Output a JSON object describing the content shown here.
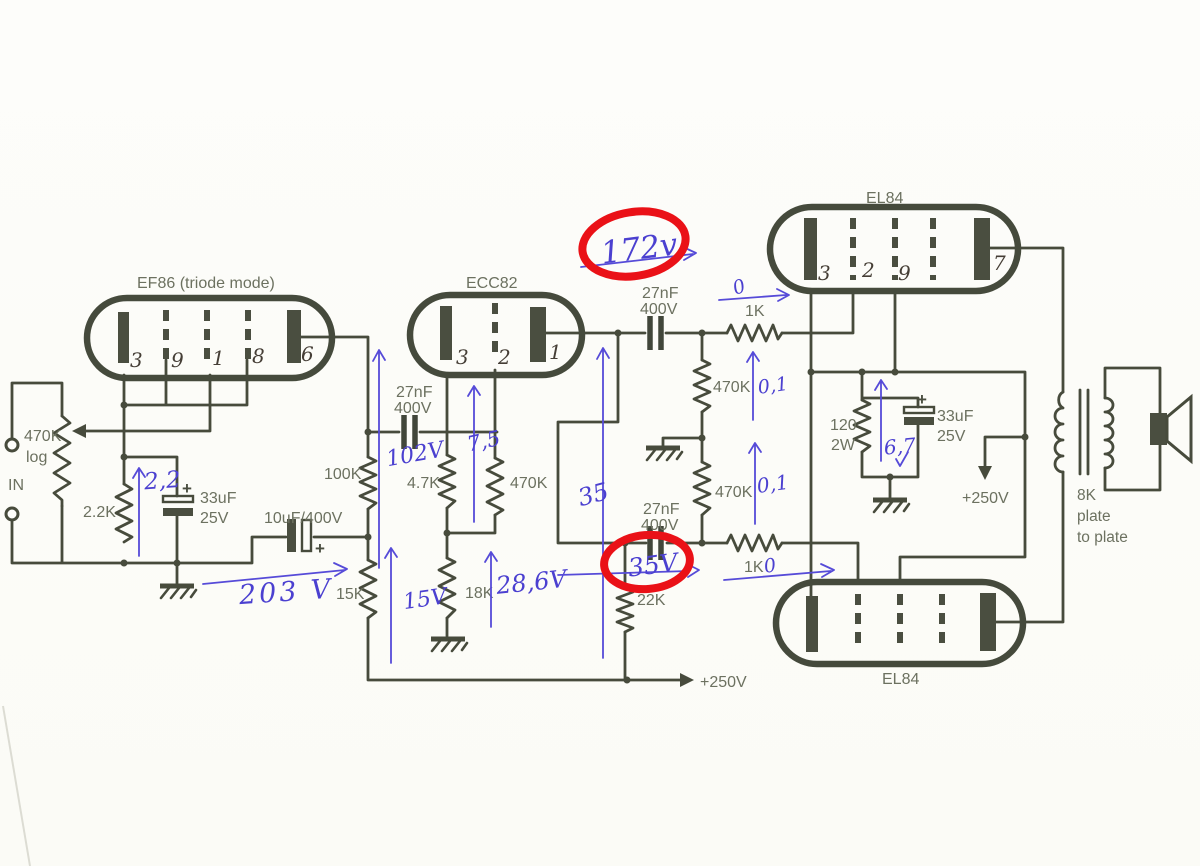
{
  "colors": {
    "ink": "#474b3c",
    "printed_text": "#6c7160",
    "handwriting_blue": "#4b40d0",
    "highlight_red": "#ea1117",
    "paper": "#fbfbf7"
  },
  "tubes": {
    "ef86": {
      "label": "EF86 (triode mode)",
      "pins": [
        "3",
        "9",
        "1",
        "8",
        "6"
      ]
    },
    "ecc82": {
      "label": "ECC82",
      "pins": [
        "3",
        "2",
        "1"
      ]
    },
    "el84_top": {
      "label": "EL84",
      "pins": [
        "3",
        "2",
        "9",
        "7"
      ]
    },
    "el84_bottom": {
      "label": "EL84"
    }
  },
  "labels": {
    "input": "IN",
    "pot_value": "470K",
    "pot_taper": "log",
    "r_2k2": "2.2K",
    "c33u_left_value": "33uF",
    "c33u_left_voltage": "25V",
    "c10u": "10uF/400V",
    "r_100k": "100K",
    "r_15k": "15K",
    "c27n_1_value": "27nF",
    "c27n_1_voltage": "400V",
    "r_4k7": "4.7K",
    "r_470k_mid": "470K",
    "r_18k": "18K",
    "c27n_top_value": "27nF",
    "c27n_top_voltage": "400V",
    "r_1k_top": "1K",
    "c27n_bot_value": "27nF",
    "c27n_bot_voltage": "400V",
    "r_1k_bot": "1K",
    "r_22k": "22K",
    "r_470k_upper": "470K",
    "r_470k_lower": "470K",
    "r_120_value": "120",
    "r_120_power": "2W",
    "c33u_right_value": "33uF",
    "c33u_right_voltage": "25V",
    "supply_mid": "+250V",
    "supply_bottom": "+250V",
    "xfmr_line1": "8K",
    "xfmr_line2": "plate",
    "xfmr_line3": "to plate",
    "plus": "+"
  },
  "annotations": {
    "v2_2": "2,2",
    "v203": "203 V",
    "v102": "102V",
    "v15": "15V",
    "v7_5": "7,5",
    "v28_6": "28,6V",
    "v35_arrow": "35",
    "v172": "172v",
    "zero_top": "0",
    "v01_upper": "0,1",
    "v01_lower": "0,1",
    "v6_7": "6,7",
    "v35_circled": "35V",
    "zero_bottom": "0"
  }
}
